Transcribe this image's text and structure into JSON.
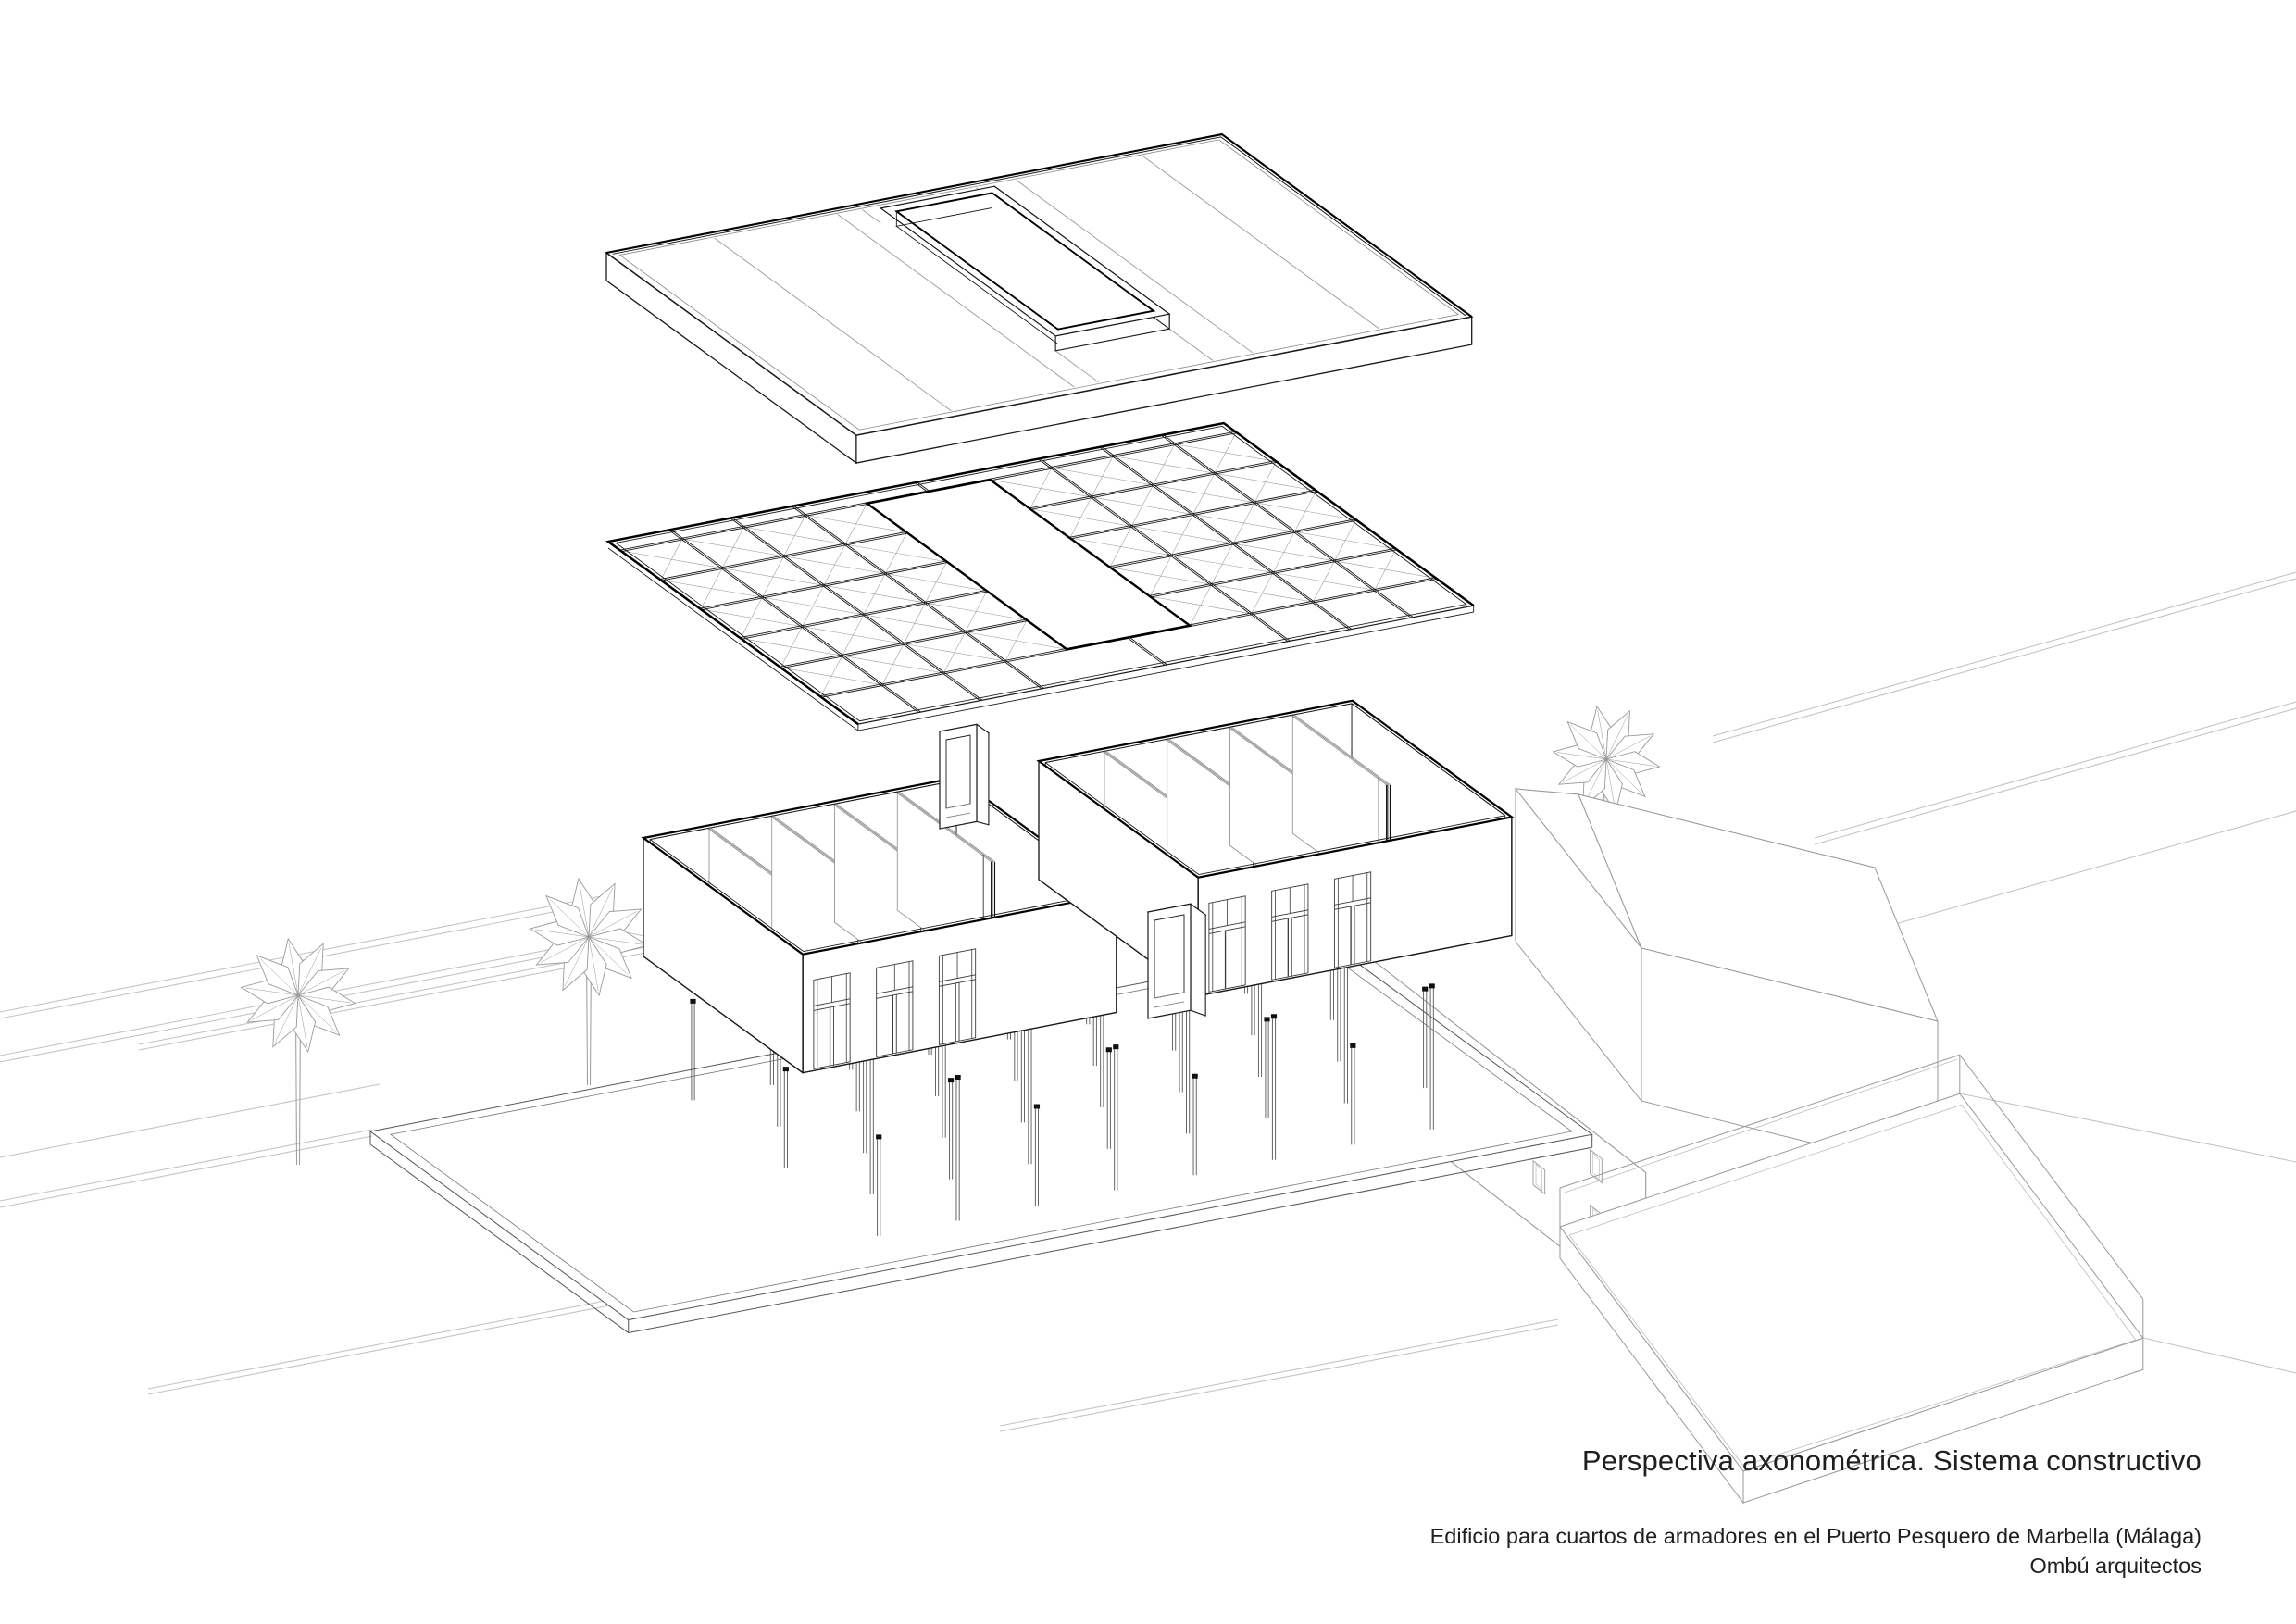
{
  "title_block": {
    "line1": "Perspectiva axonométrica. Sistema constructivo",
    "line2": "Edificio para cuartos de armadores en el Puerto Pesquero de Marbella (Málaga)",
    "line3": "Ombú arquitectos"
  },
  "colors": {
    "background": "#ffffff",
    "ink": "#1a1a1a",
    "heavy": "#000000",
    "medium": "#555555",
    "soft": "#8a8a8a",
    "light": "#999999",
    "faint": "#bdbdbd",
    "ground": "#c4c4c4",
    "pile_cap": "#111111"
  },
  "scene": {
    "projection": "exploded dimetric axonometric",
    "layers_top_to_bottom": [
      "roof-slab",
      "roof-structural-grid",
      "room-modules",
      "door-portals",
      "pile-foundation",
      "site-context"
    ],
    "roof": {
      "panel_division_lines": 4,
      "skylight_curb": true
    },
    "grid": {
      "bays_long": 10,
      "bays_wide": 5,
      "cross_braced": true,
      "central_opening": true
    },
    "modules": {
      "count": 2,
      "rooms_per_module": 5,
      "door_groups_visible_per_module": 3
    },
    "door_portals": {
      "count": 2
    },
    "foundation": {
      "pile_cols": 8,
      "pile_rows": 5
    },
    "site": {
      "palm_trees": 4,
      "warehouse_hipped_roof": true,
      "facade_window_rows": 2,
      "facade_window_cols": 5,
      "dock_platform": true
    }
  }
}
